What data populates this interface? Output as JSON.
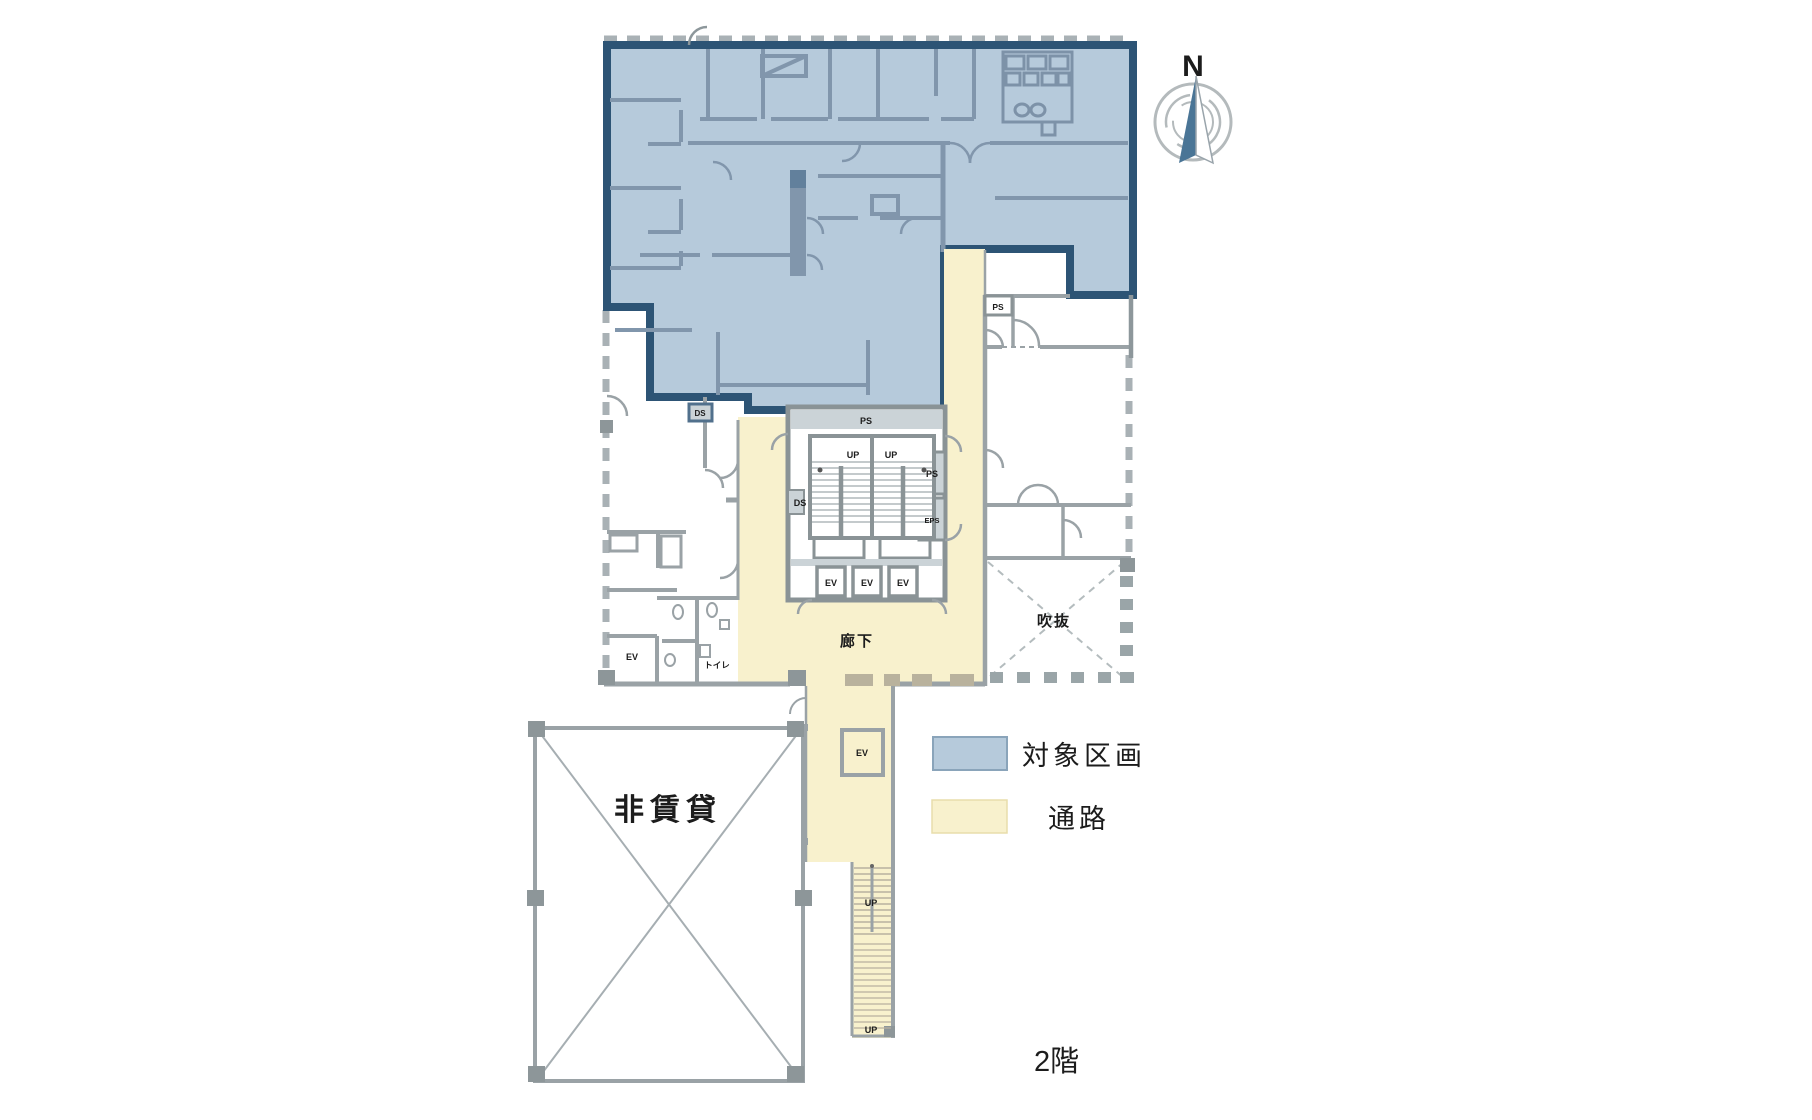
{
  "floor_plan": {
    "floor_label": "2階",
    "compass": {
      "north_label": "N",
      "needle_color": "#4a7596"
    },
    "legend": {
      "items": [
        {
          "label": "対象区画",
          "color": "#b6cadb"
        },
        {
          "label": "通路",
          "color": "#f8f1cd"
        }
      ]
    },
    "area_labels": {
      "corridor": "廊下",
      "atrium": "吹抜",
      "non_rental": "非賃貸",
      "toilet": "トイレ"
    },
    "room_codes": {
      "ev": "EV",
      "ps": "PS",
      "ds": "DS",
      "eps": "EPS",
      "up": "UP"
    },
    "colors": {
      "target_section": "#b6cadb",
      "target_border": "#2d5475",
      "passage": "#f8f1cd",
      "wall": "#8d979b"
    }
  }
}
